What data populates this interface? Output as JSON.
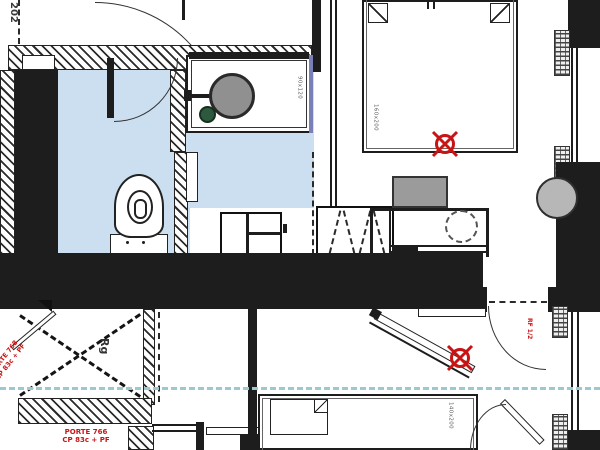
{
  "plan": {
    "room_number": "202",
    "stair_label": "Rg",
    "labels": {
      "door_bottom_line1": "PORTE 766",
      "door_bottom_line2": "CP 83c + PF",
      "door_diag_line1": "PORTE 768",
      "door_diag_line2": "CP 83c + PF",
      "window_note": "RF 1/2",
      "shower_dim": "90x120",
      "bed_main_dim": "160x200",
      "bed_second_dim": "140x200"
    },
    "colors": {
      "wall_ink": "#1d1d1d",
      "bathroom_floor": "#cbdff1",
      "annotation_red": "#c81414",
      "section_line_cyan": "#9cc8d0",
      "shower_glass_purple": "#7b7fb8",
      "drain_gray": "#909090",
      "floor_drain_green": "#2d5a3f",
      "chair_gray": "#9b9b9b",
      "column_gray": "#b7b7b7"
    },
    "icons": [
      "survey-crosshair-icon"
    ]
  }
}
